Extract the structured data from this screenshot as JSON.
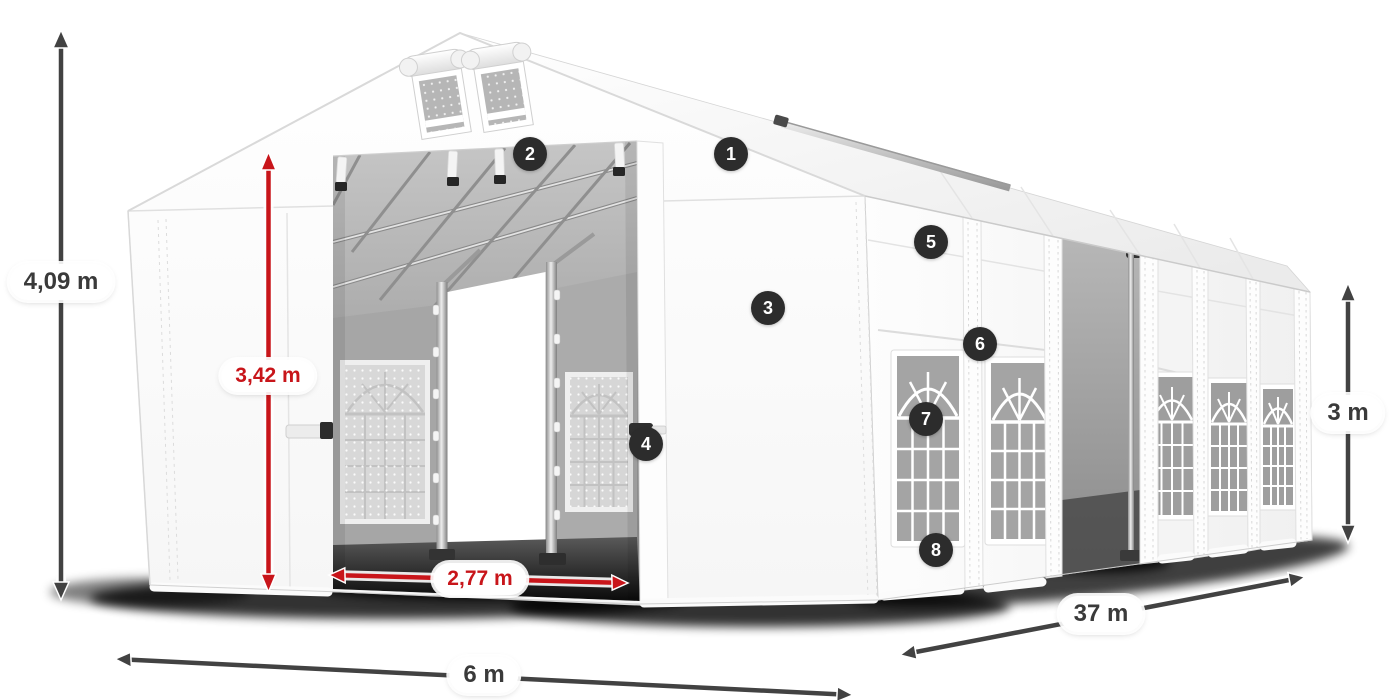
{
  "diagram": {
    "product": "party-tent-dimensions",
    "dimensions": {
      "total_height": "4,09 m",
      "entrance_height": "3,42 m",
      "entrance_width": "2,77 m",
      "width": "6 m",
      "length": "37 m",
      "side_height": "3 m"
    },
    "callouts": [
      "1",
      "2",
      "3",
      "4",
      "5",
      "6",
      "7",
      "8"
    ],
    "colors": {
      "accent_red": "#c8151a",
      "dimension_dark": "#404040",
      "badge_background": "#2c2c2c",
      "tent_white": "#ffffff",
      "interior_gray": "#a8a8a8"
    }
  }
}
